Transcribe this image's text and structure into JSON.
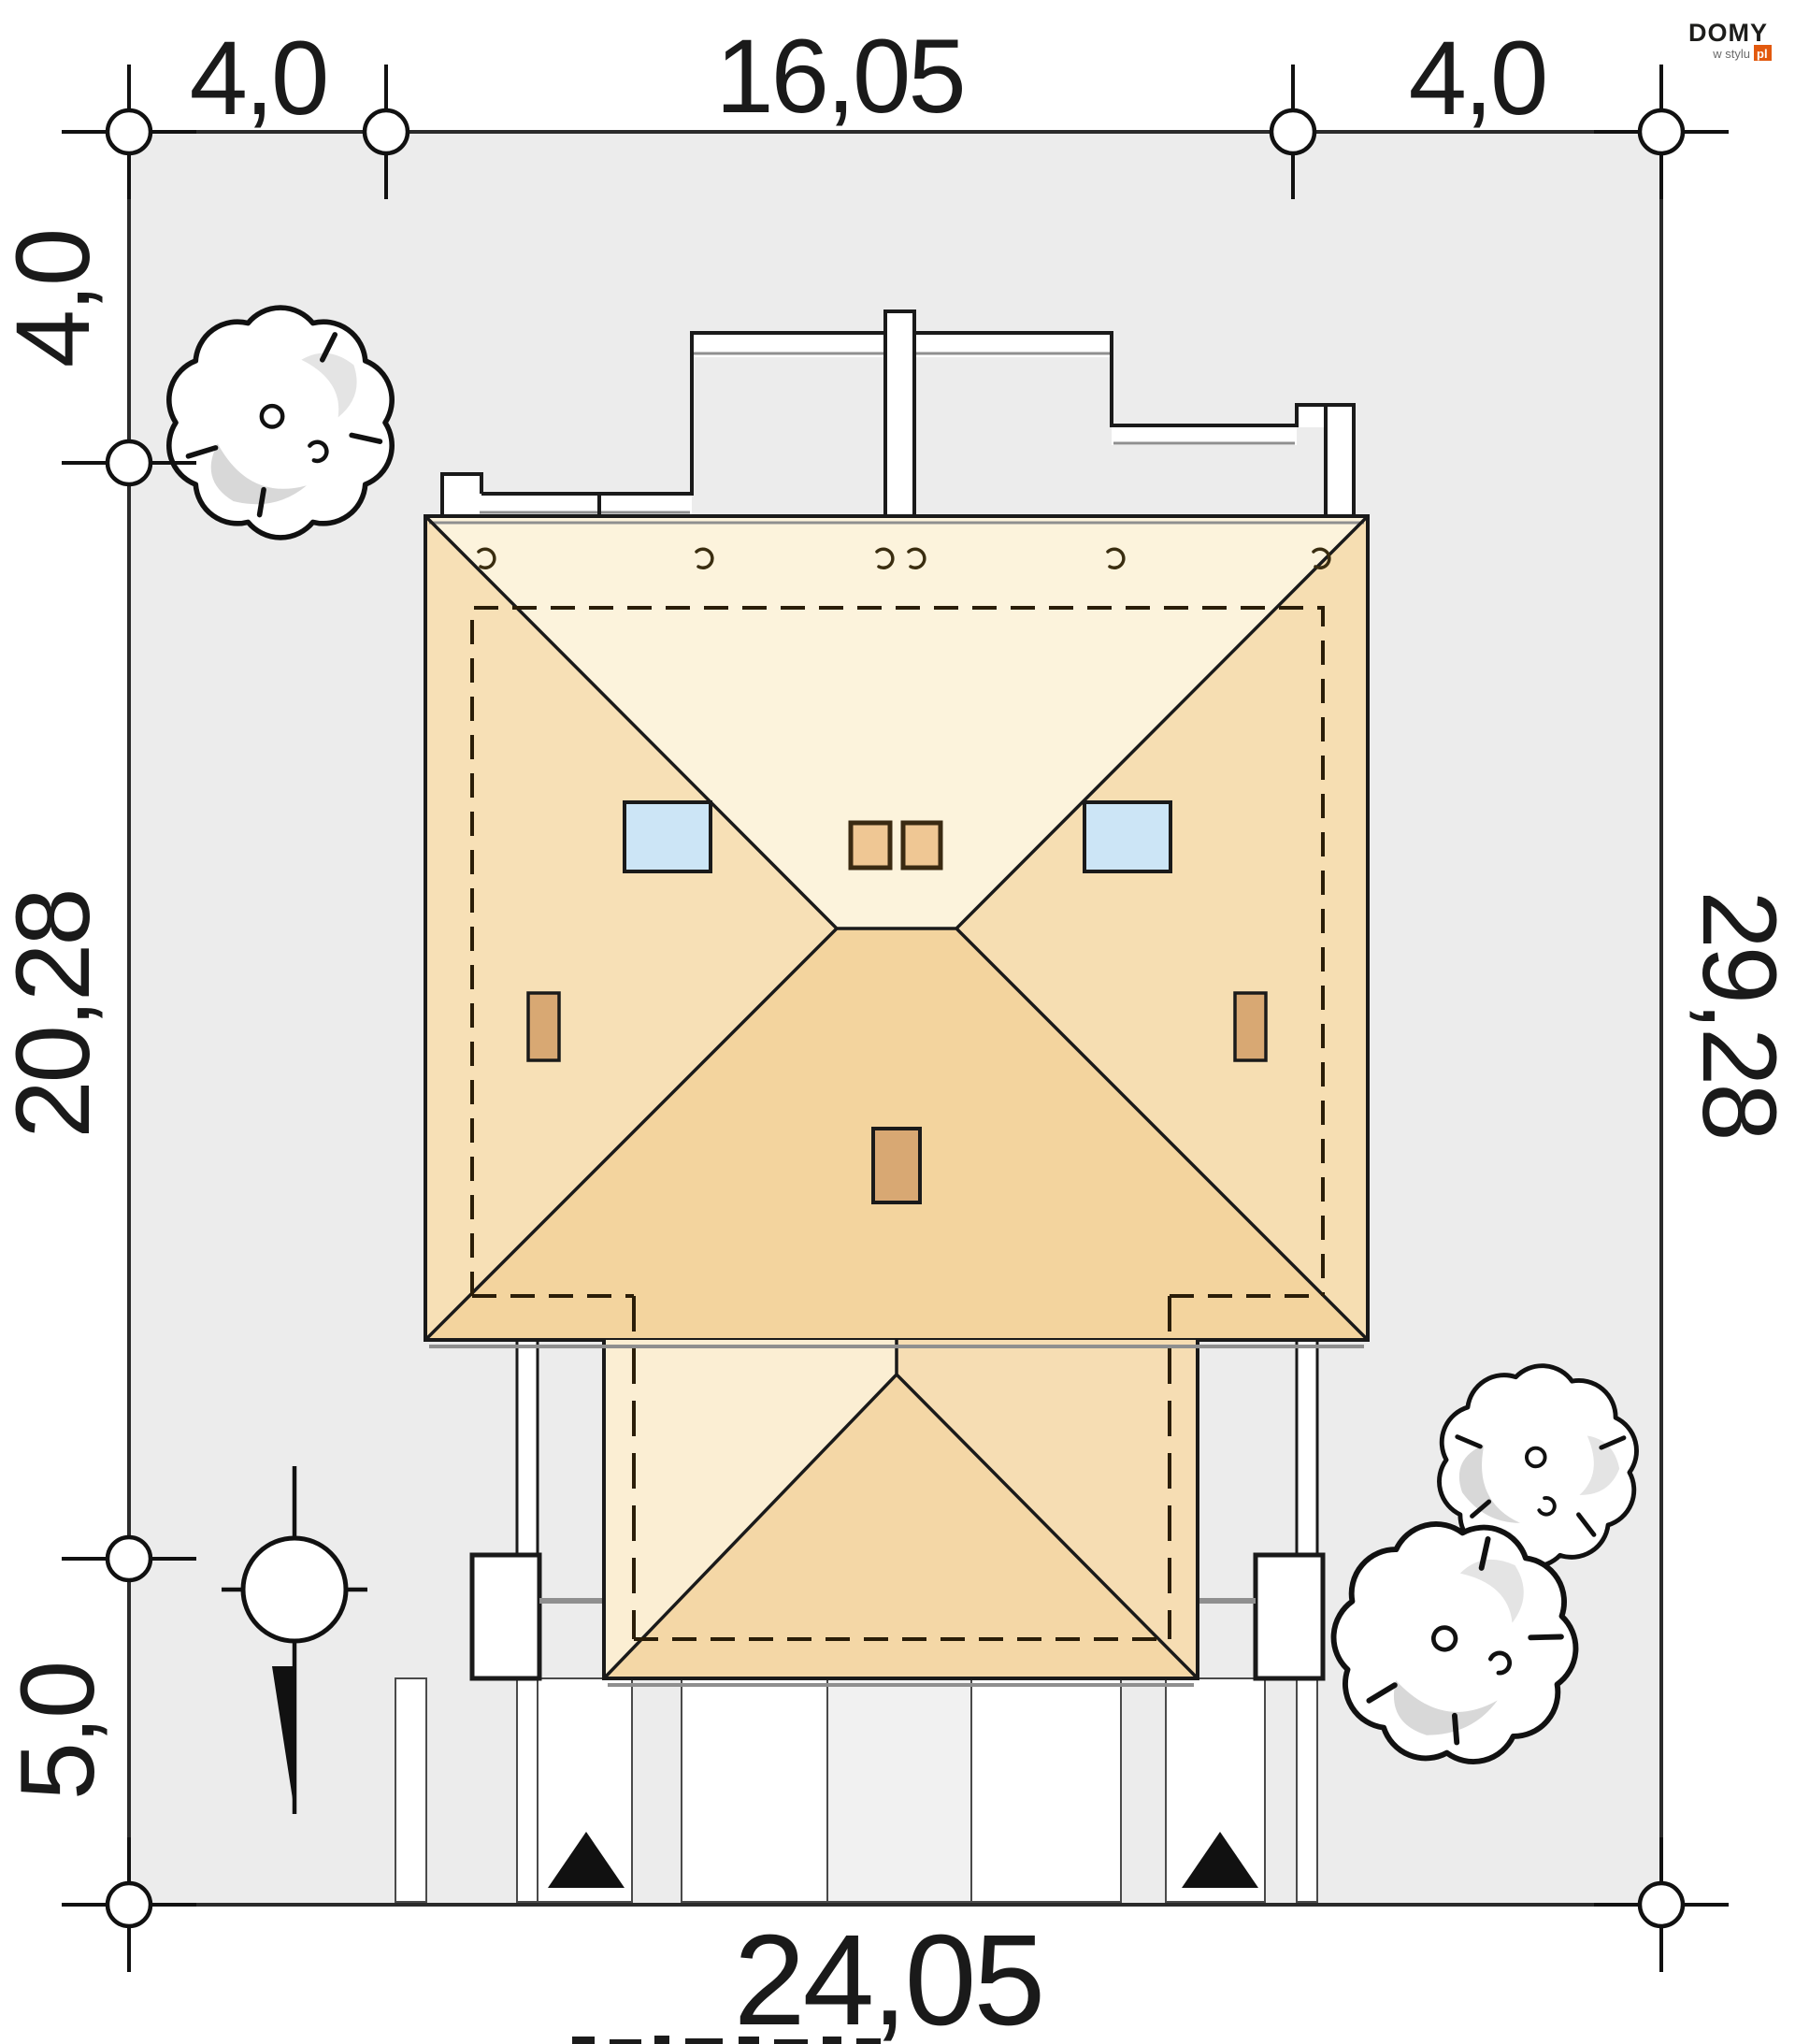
{
  "logo": {
    "brand": "DOMY",
    "sub": "w stylu",
    "tld": "pl",
    "accent": "#E2590E"
  },
  "dims": {
    "top": [
      {
        "label": "4,0"
      },
      {
        "label": "16,05"
      },
      {
        "label": "4,0"
      }
    ],
    "left": [
      {
        "label": "4,0"
      },
      {
        "label": "20,28"
      },
      {
        "label": "5,0"
      }
    ],
    "right": [
      {
        "label": "29,28"
      }
    ],
    "bottom": [
      {
        "label": "24,05"
      }
    ]
  },
  "colors": {
    "plot_fill": "#ECECEC",
    "plot_border": "#2B2B2B",
    "roof_top": "#FCF3DC",
    "roof_left": "#F7E0B6",
    "roof_right": "#F6DEB2",
    "roof_bottom": "#F3D49E",
    "wing_left": "#FBEED3",
    "wing_right": "#F6DDB3",
    "wing_front": "#F4D7A6",
    "skylight": "#CCE5F6",
    "chimney_cap": "#EFC794",
    "vent": "#D8A873",
    "paving": "#FFFFFF",
    "tree_shadow": "#D8D8D8",
    "outline": "#1A1A1A"
  }
}
